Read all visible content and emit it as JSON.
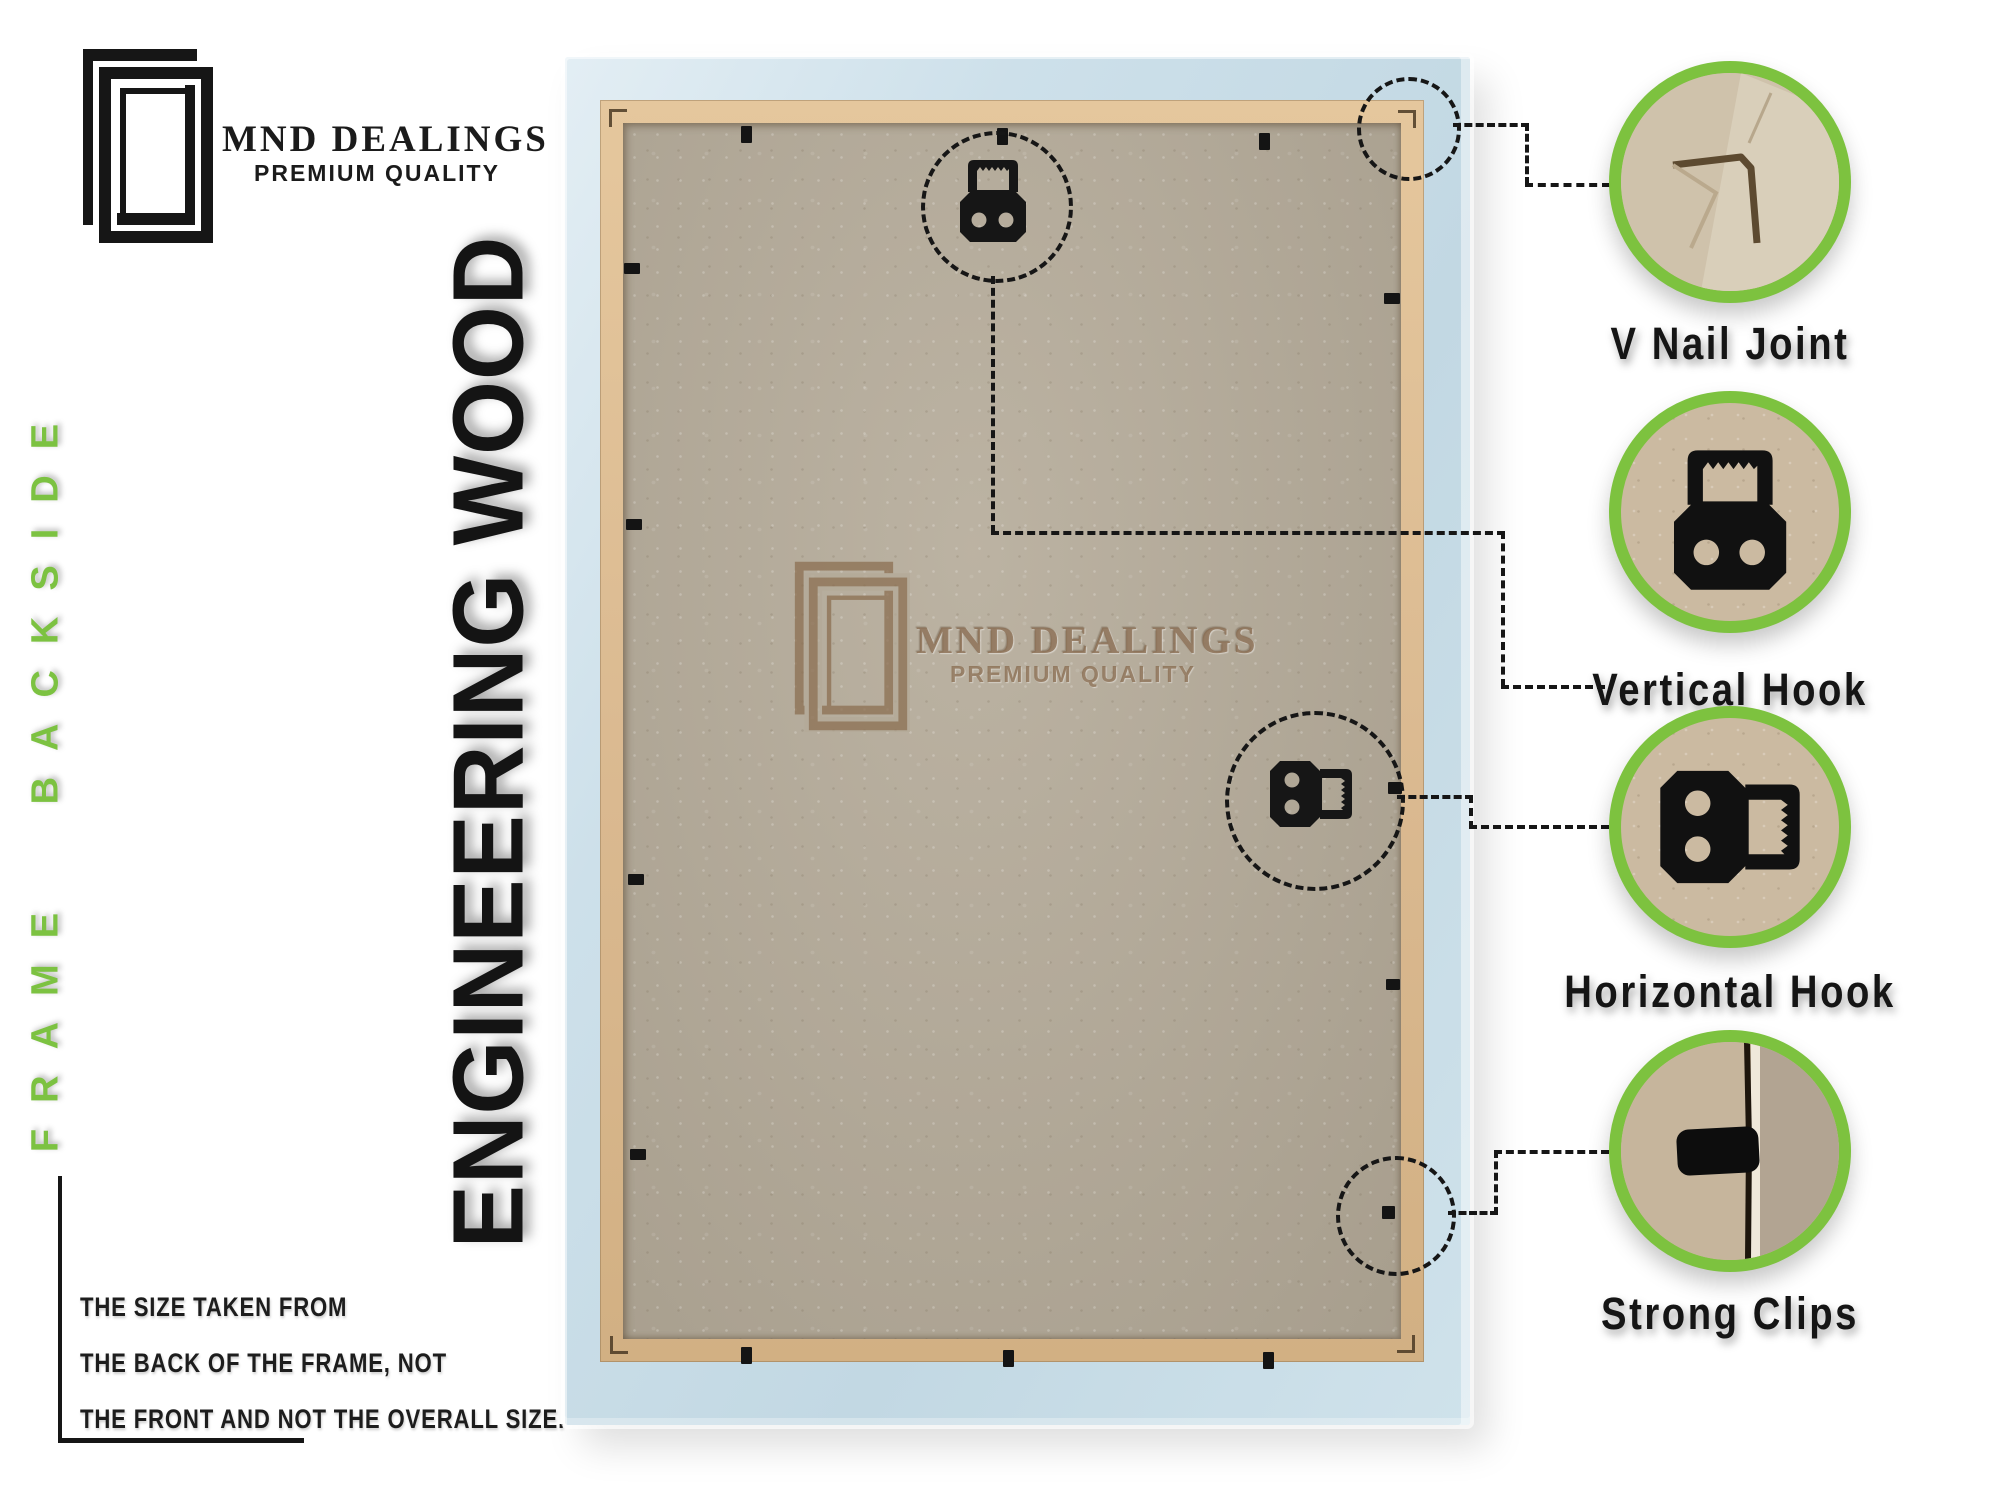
{
  "brand": {
    "name": "MND DEALINGS",
    "tagline": "PREMIUM QUALITY"
  },
  "side_label": "FRAME BACKSIDE",
  "material_label": "ENGINEERING WOOD",
  "size_note": {
    "lines": [
      "THE SIZE TAKEN FROM",
      "THE BACK OF THE FRAME, NOT",
      "THE FRONT AND NOT THE OVERALL SIZE."
    ]
  },
  "callouts": [
    {
      "label": "V Nail Joint"
    },
    {
      "label": "Vertical Hook"
    },
    {
      "label": "Horizontal Hook"
    },
    {
      "label": "Strong Clips"
    }
  ],
  "colors": {
    "accent_green": "#7dc23f",
    "frame_blue": "#cde0ea",
    "wood_tan": "#dab990",
    "mdf_board": "#b4aa98",
    "ink": "#161616"
  }
}
